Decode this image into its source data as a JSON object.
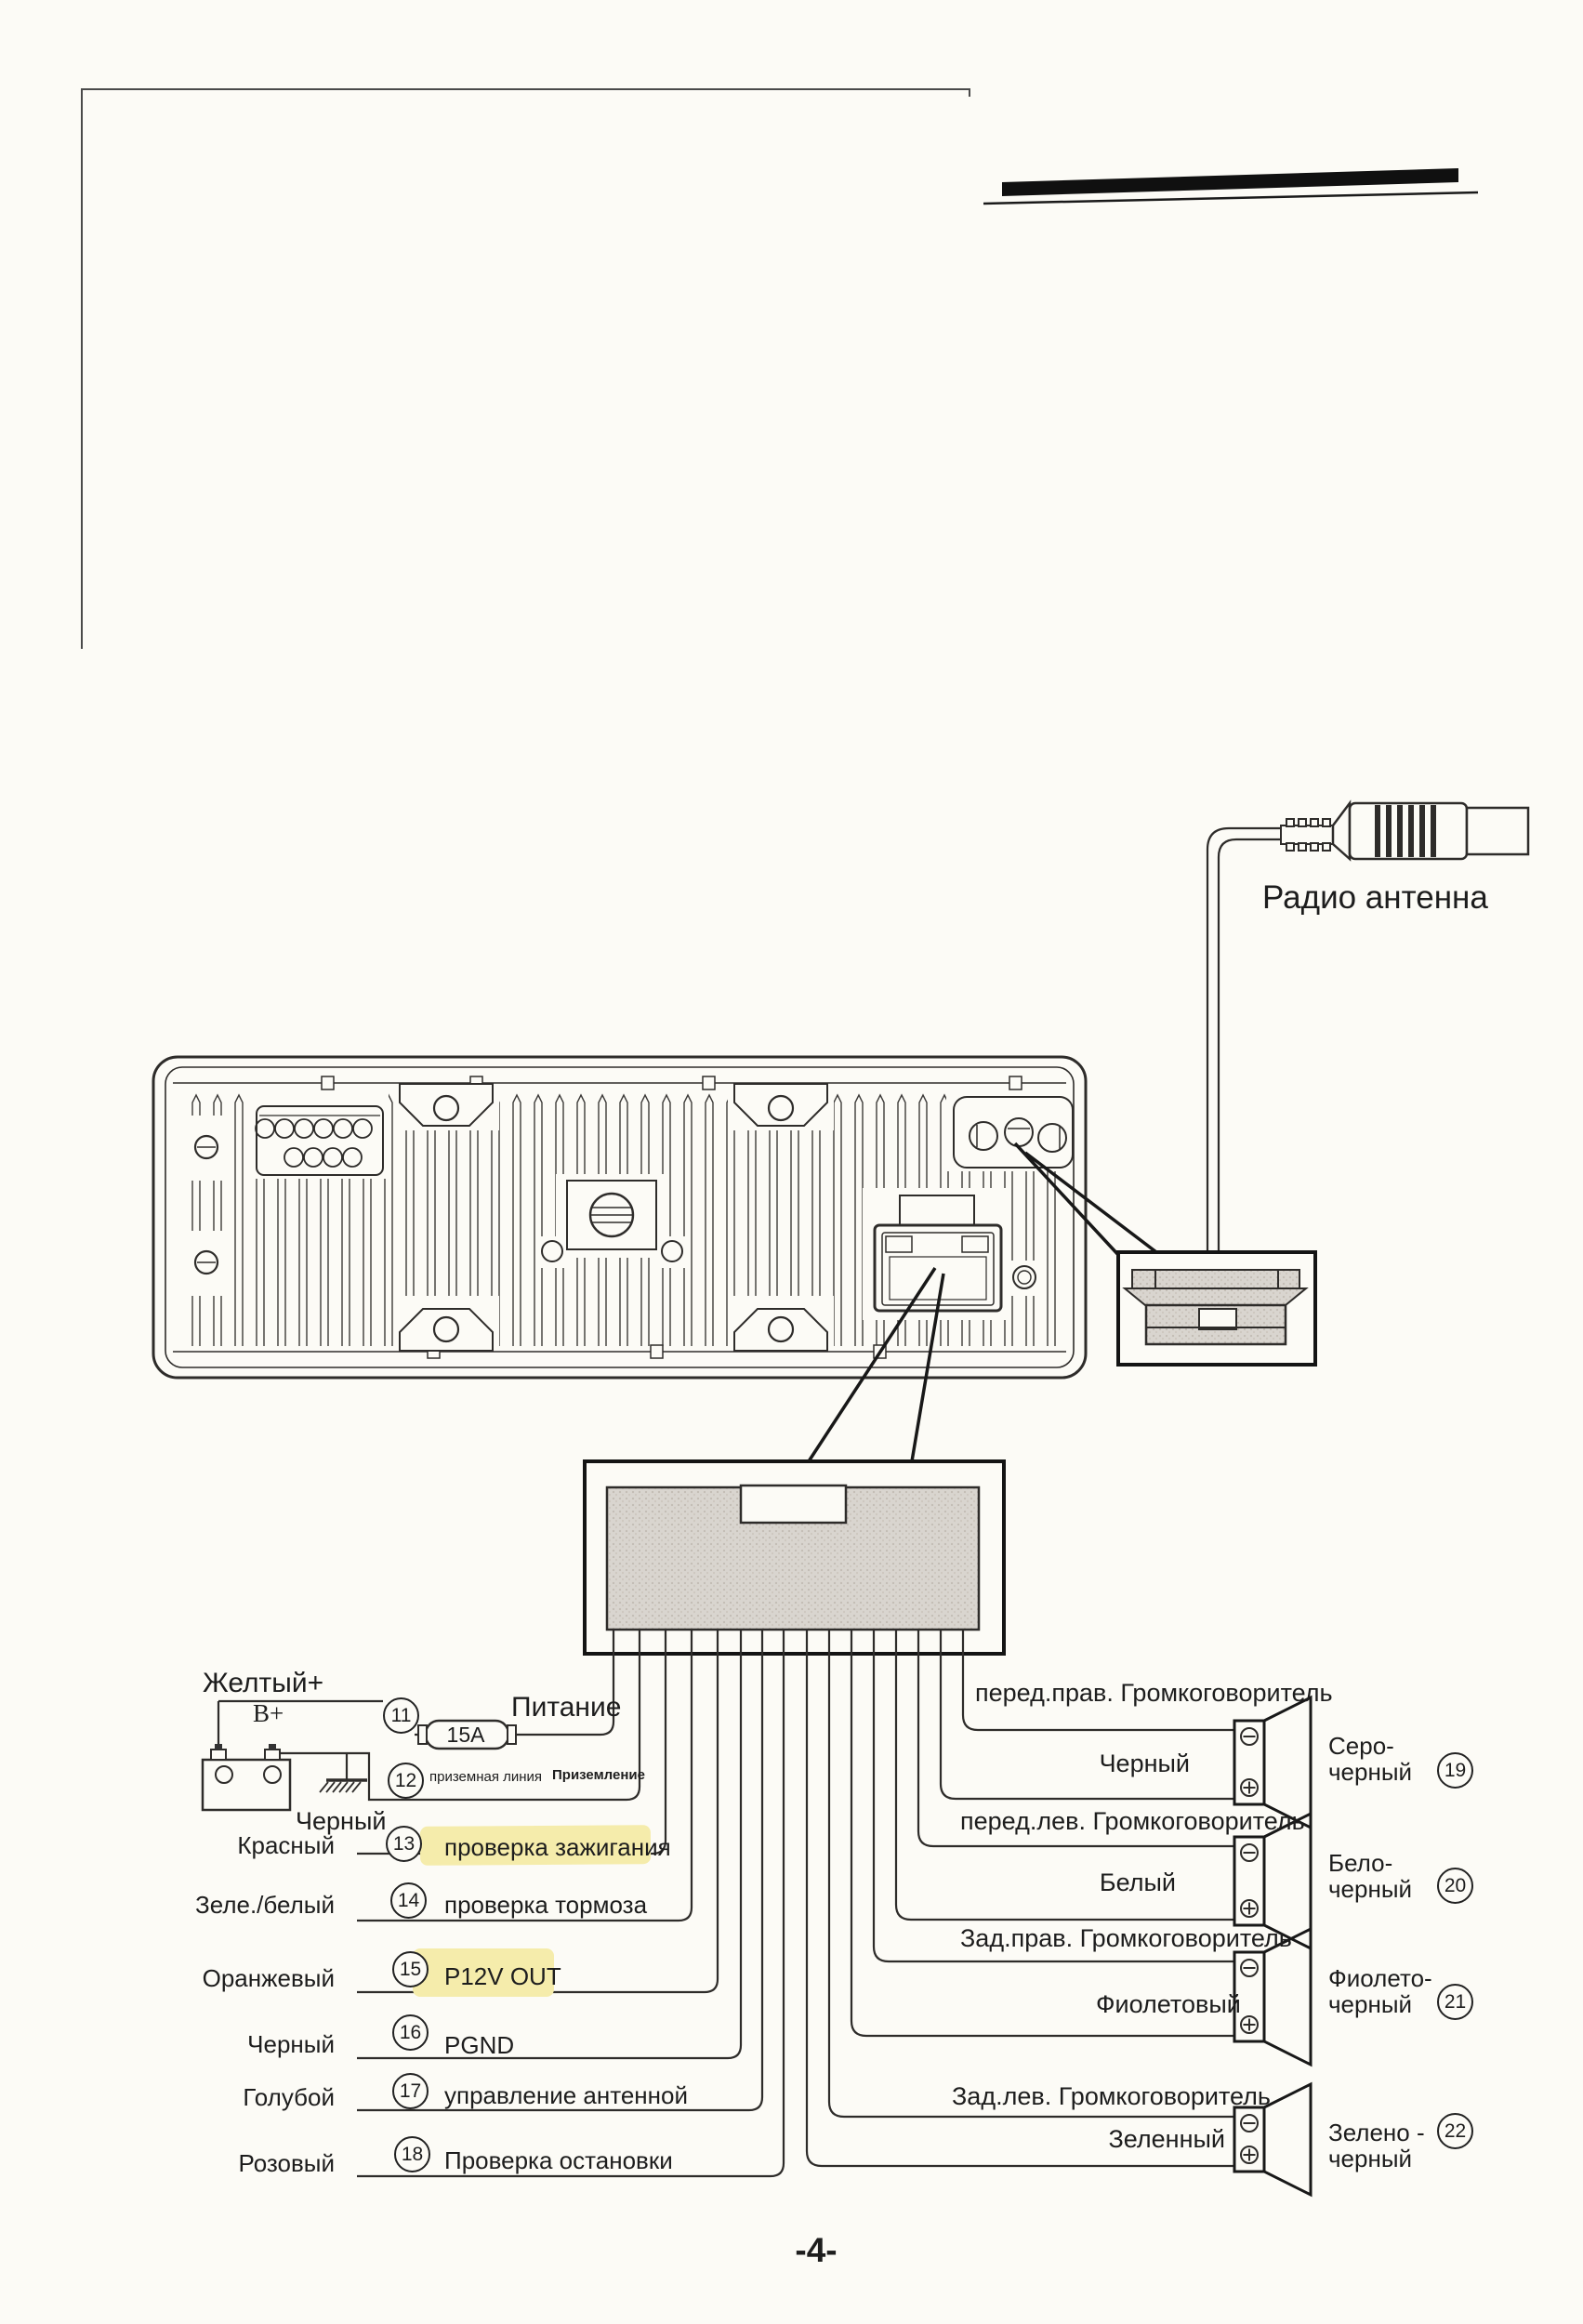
{
  "page": {
    "footer": "-4-"
  },
  "antenna": {
    "label": "Радио антенна"
  },
  "diagram": {
    "power": {
      "battery_wire_label": "Желтый+",
      "battery_terminal_label": "B+",
      "row11_num": "11",
      "row11_function": "Питание",
      "fuse_label": "15A",
      "row12_num": "12",
      "row12_function_a": "приземная линия",
      "row12_function_b": "Приземление",
      "ground_wire_label": "Черный"
    },
    "left_rows": [
      {
        "num": "13",
        "color": "Красный",
        "function": "проверка зажигания",
        "highlighted": true
      },
      {
        "num": "14",
        "color": "Зеле./белый",
        "function": "проверка тормоза",
        "highlighted": false
      },
      {
        "num": "15",
        "color": "Оранжевый",
        "function": "P12V OUT",
        "highlighted": true
      },
      {
        "num": "16",
        "color": "Черный",
        "function": "PGND",
        "highlighted": false
      },
      {
        "num": "17",
        "color": "Голубой",
        "function": "управление антенной",
        "highlighted": false
      },
      {
        "num": "18",
        "color": "Розовый",
        "function": "Проверка остановки",
        "highlighted": false
      }
    ],
    "speakers": [
      {
        "num": "19",
        "position": "перед.прав. Громкоговоритель",
        "wire": "Черный",
        "combo1": "Серо-",
        "combo2": "черный"
      },
      {
        "num": "20",
        "position": "перед.лев. Громкоговоритель",
        "wire": "Белый",
        "combo1": "Бело-",
        "combo2": "черный"
      },
      {
        "num": "21",
        "position": "Зад.прав. Громкоговоритель",
        "wire": "Фиолетовый",
        "combo1": "Фиолето-",
        "combo2": "черный"
      },
      {
        "num": "22",
        "position": "Зад.лев. Громкоговоритель",
        "wire": "Зеленный",
        "combo1": "Зелено -",
        "combo2": "черный"
      }
    ]
  },
  "colors": {
    "highlight": "#f5ecab",
    "ink": "#2e2c2a",
    "paper": "#fcfbf6",
    "fill_gray": "#d9d5cf"
  }
}
